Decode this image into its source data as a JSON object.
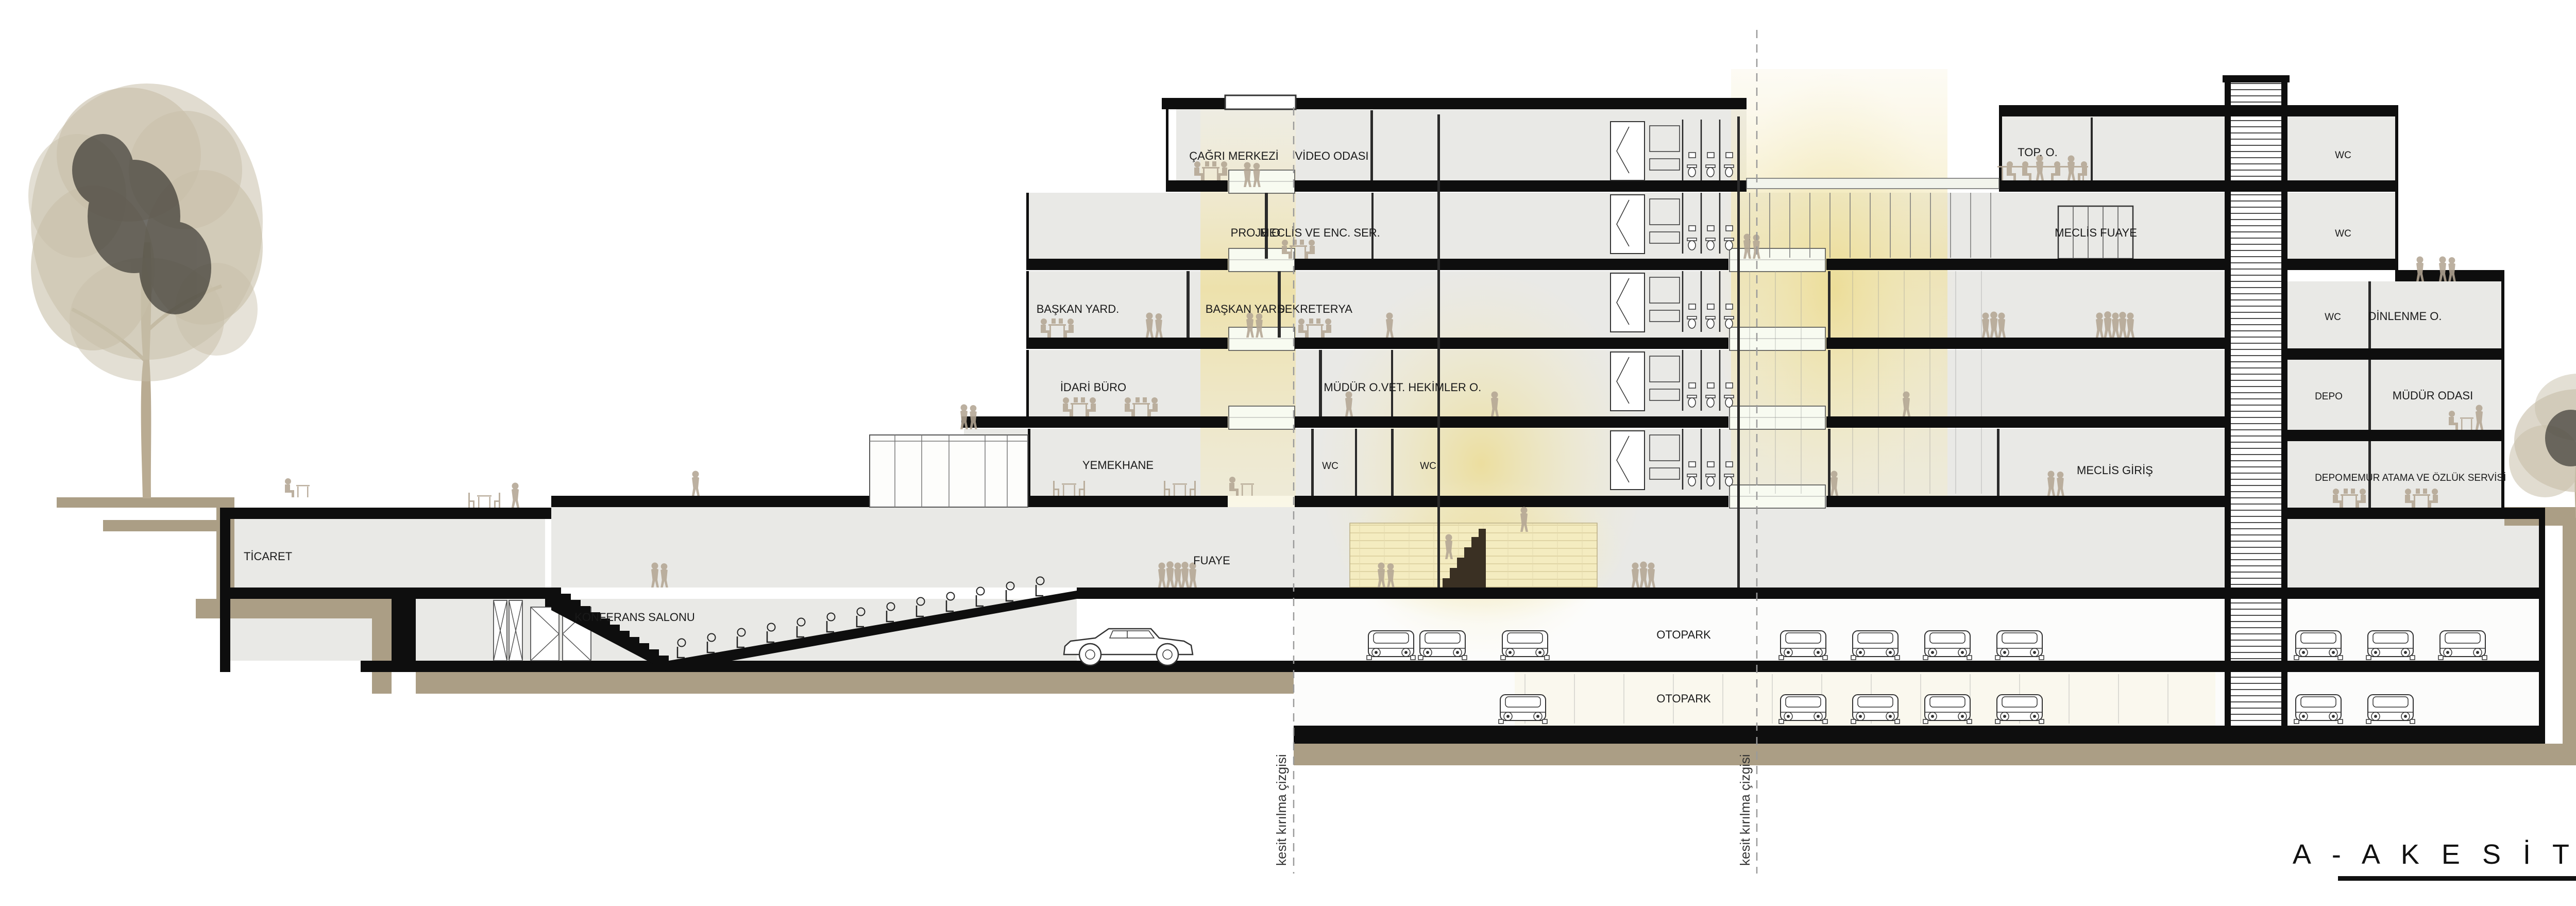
{
  "title": {
    "text": "A - A  K E S İ T  1 / 2 0 0"
  },
  "section_break_label": "kesit kırılma çizgisi",
  "levels": [
    {
      "elevation": "+13.95 (+50.95)",
      "name": "H max"
    },
    {
      "elevation": "+12.00 (+49.00)",
      "name": "ÇATI"
    },
    {
      "elevation": "+8.00",
      "name": "2. KAT"
    },
    {
      "elevation": "+4.00",
      "name": "1. KAT"
    },
    {
      "elevation": "H_MAKS [±0.00 (+38.45)]",
      "name": ""
    },
    {
      "elevation": "±0.00 (+37.00)",
      "name": "ZEMİN KAT"
    },
    {
      "elevation": "-4.00",
      "name": "1.BODRUM KAT"
    },
    {
      "elevation": "-8.00",
      "name": "2.BODRUM KAT"
    },
    {
      "elevation": "-12.00(+25.00)",
      "name": "3.BODRUM KAT"
    },
    {
      "elevation": "-15.20",
      "name": "4.BODRUM KAT"
    },
    {
      "elevation": "-18.40",
      "name": "5.BODRUM KAT"
    }
  ],
  "rooms": [
    {
      "label": "ÇAĞRI MERKEZİ"
    },
    {
      "label": "VİDEO ODASI"
    },
    {
      "label": "TOP. O."
    },
    {
      "label": "WC"
    },
    {
      "label": "PROJE O."
    },
    {
      "label": "MECLİS VE ENC. SER."
    },
    {
      "label": "MECLİS FUAYE"
    },
    {
      "label": "WC"
    },
    {
      "label": "BAŞKAN YARD."
    },
    {
      "label": "BAŞKAN YARD."
    },
    {
      "label": "SEKRETERYA"
    },
    {
      "label": "WC"
    },
    {
      "label": "DİNLENME O."
    },
    {
      "label": "İDARİ BÜRO"
    },
    {
      "label": "MÜDÜR O."
    },
    {
      "label": "VET. HEKİMLER O."
    },
    {
      "label": "DEPO"
    },
    {
      "label": "MÜDÜR ODASI"
    },
    {
      "label": "YEMEKHANE"
    },
    {
      "label": "WC"
    },
    {
      "label": "WC"
    },
    {
      "label": "MECLİS GİRİŞ"
    },
    {
      "label": "DEPO"
    },
    {
      "label": "MEMUR ATAMA VE ÖZLÜK SERVİSİ"
    },
    {
      "label": "TİCARET"
    },
    {
      "label": "KONFERANS SALONU"
    },
    {
      "label": "FUAYE"
    },
    {
      "label": "OTOPARK"
    },
    {
      "label": "OTOPARK"
    }
  ],
  "colors": {
    "ink": "#1a1a1a",
    "slab": "#0e0e0e",
    "room": "#e9e9e6",
    "parking": "#fcfcfb",
    "ground": "#ab9e85",
    "tree": "#c8bfa9",
    "people": "#b3a593",
    "glow": "#eedf9d",
    "glow_soft": "#f5eec8",
    "balcony": "#f8fbf1",
    "marker": "#9a9a9a"
  }
}
